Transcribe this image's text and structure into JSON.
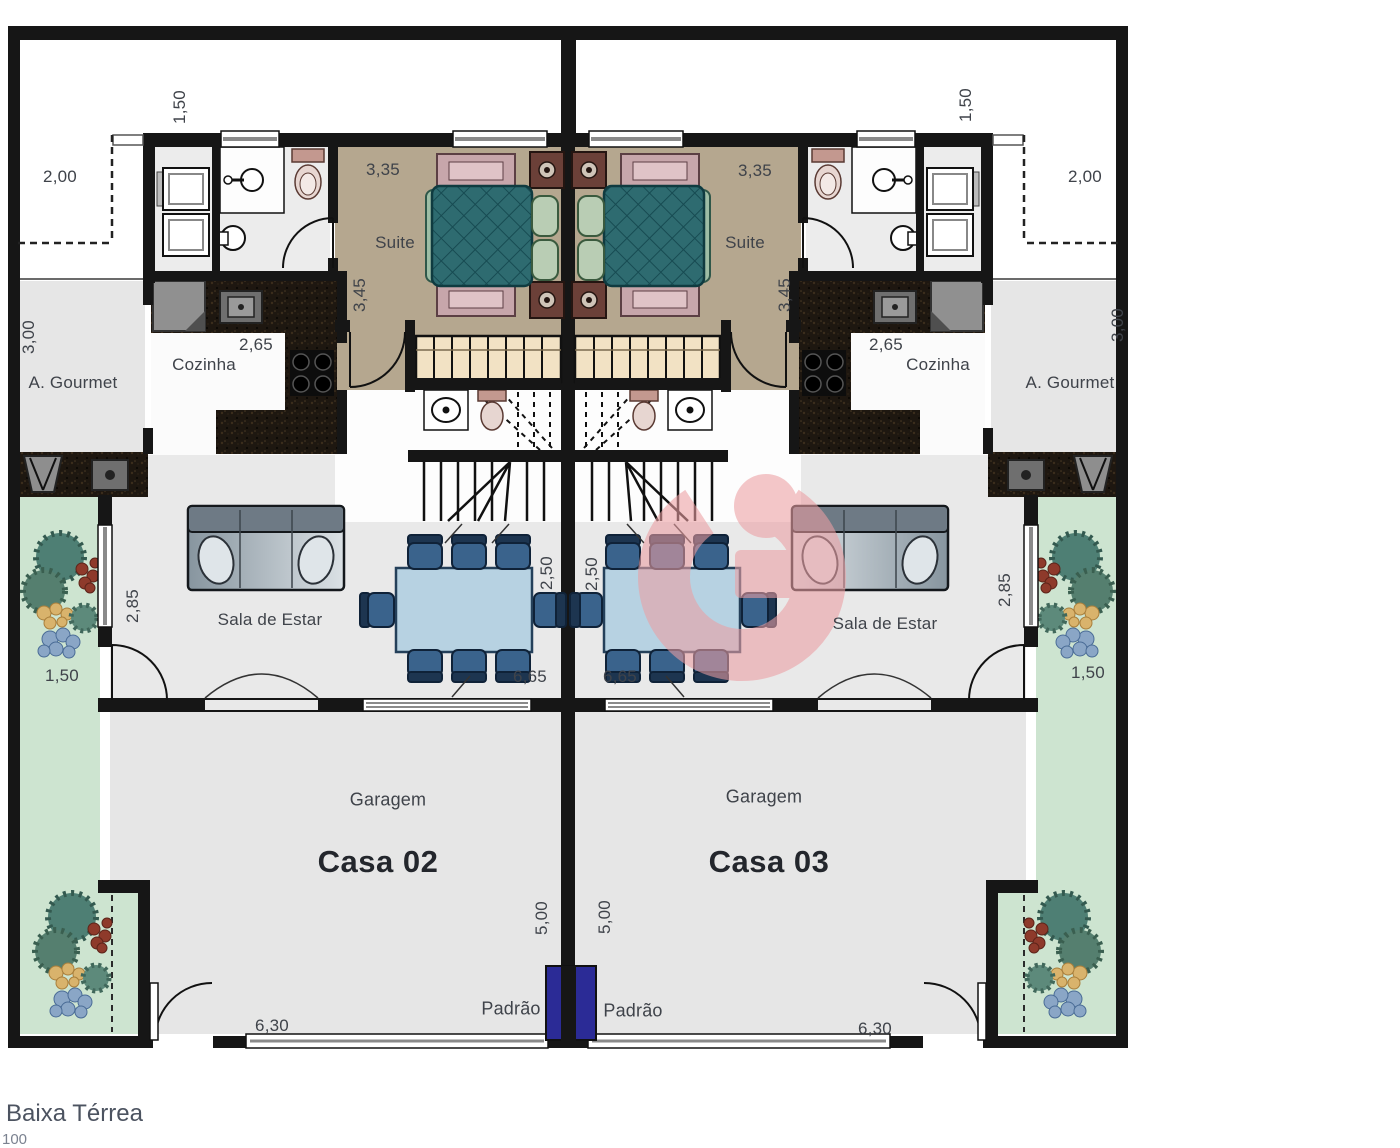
{
  "footer": {
    "plan_name": "Baixa Térrea",
    "scale_fragment": "100"
  },
  "watermark": {
    "name": "builder-logo-g",
    "color": "#ec9fa3"
  },
  "utility": {
    "padrao_box_color": "#2b2b96"
  },
  "houses": [
    {
      "name": "Casa 02",
      "rooms": {
        "suite": "Suite",
        "kitchen": "Cozinha",
        "gourmet": "A. Gourmet",
        "living": "Sala de Estar",
        "garage": "Garagem"
      },
      "labels": {
        "padrao": "Padrão"
      },
      "dims": {
        "front_terrace": "1,50",
        "corner_setback": "2,00",
        "gourmet_depth": "3,00",
        "kitchen_width": "2,65",
        "suite_width": "3,35",
        "suite_depth": "3,45",
        "living_window": "2,85",
        "garden_width": "1,50",
        "dining_depth": "2,50",
        "living_width": "6,65",
        "garage_depth": "5,00",
        "garage_width": "6,30"
      }
    },
    {
      "name": "Casa 03",
      "rooms": {
        "suite": "Suite",
        "kitchen": "Cozinha",
        "gourmet": "A. Gourmet",
        "living": "Sala de Estar",
        "garage": "Garagem"
      },
      "labels": {
        "padrao": "Padrão"
      },
      "dims": {
        "front_terrace": "1,50",
        "corner_setback": "2,00",
        "gourmet_depth": "3,00",
        "kitchen_width": "2,65",
        "suite_width": "3,35",
        "suite_depth": "3,45",
        "living_window": "2,85",
        "garden_width": "1,50",
        "dining_depth": "2,50",
        "living_width": "6,65",
        "garage_depth": "5,00",
        "garage_width": "6,30"
      }
    }
  ],
  "palette": {
    "wall": "#161616",
    "suite_floor": "#b5a78f",
    "floor_gray": "#e8e8e8",
    "garden": "#cde4d0",
    "counter": "#1e1710",
    "wardrobe": "#f2e2c4",
    "bed": "#2e6b70",
    "table": "#b7d2e2",
    "sofa": "#aeb9c1"
  }
}
